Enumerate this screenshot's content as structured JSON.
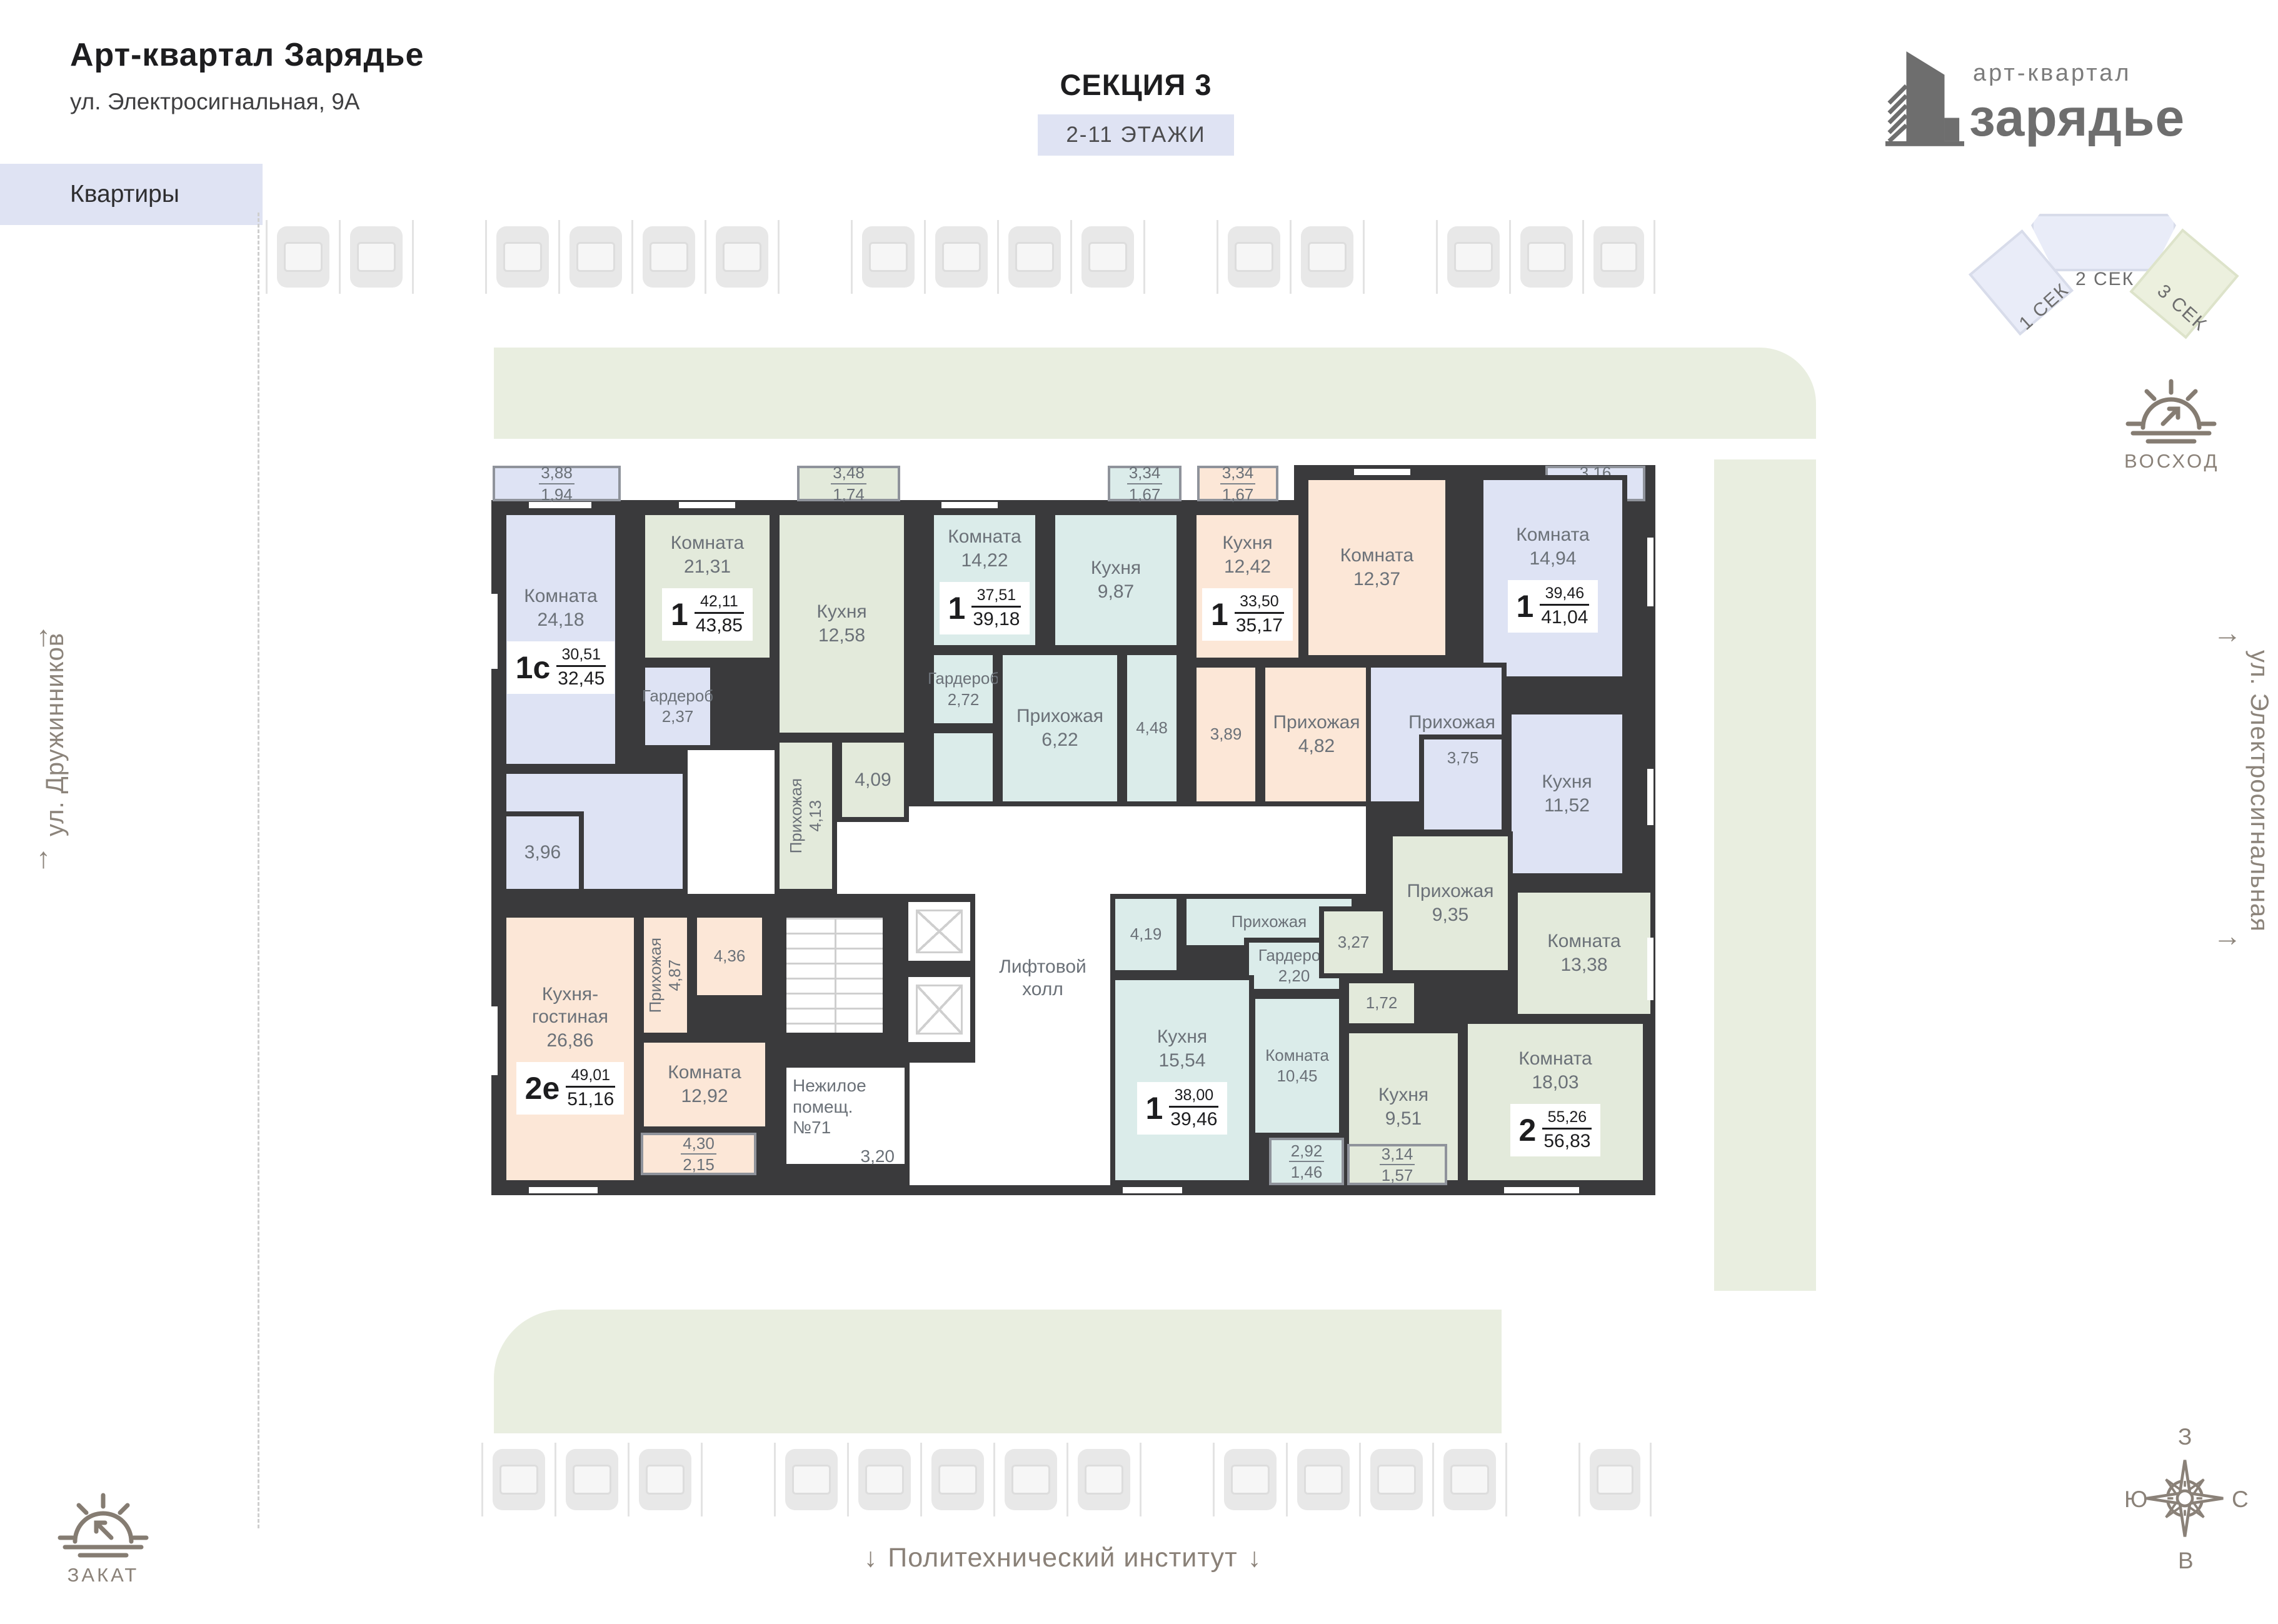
{
  "header": {
    "title": "Арт-квартал Зарядье",
    "address": "ул. Электросигнальная, 9А",
    "tab": "Квартиры"
  },
  "section": {
    "title": "СЕКЦИЯ 3",
    "floors": "2-11 ЭТАЖИ"
  },
  "logo": {
    "line1": "арт-квартал",
    "line2": "зарядье"
  },
  "minimap": {
    "sec1": "1 СЕК",
    "sec2": "2 СЕК",
    "sec3": "3 СЕК"
  },
  "orientation": {
    "sunrise": "ВОСХОД",
    "sunset": "ЗАКАТ",
    "compass": {
      "top": "З",
      "right": "С",
      "bottom": "В",
      "left": "Ю"
    }
  },
  "streets": {
    "left": "ул. Дружинников",
    "right": "ул. Электросигнальная",
    "landmark": "Политехнический институт"
  },
  "icons": {
    "up_arrow": "↑",
    "down_arrow": "↓",
    "flow_arrow": "→"
  },
  "core": {
    "lift_hall": "Лифтовой холл",
    "nonresidential": "Нежилое помещ. №71",
    "nonresidential_area": "3,20"
  },
  "apartments": [
    {
      "label": "1с",
      "area_living": "30,51",
      "area_total": "32,45",
      "rooms": [
        {
          "name": "Комната",
          "area": "24,18"
        },
        {
          "name": "",
          "area": "3,96"
        },
        {
          "name": "Гардероб",
          "area": "2,37"
        }
      ],
      "balcony": {
        "upper": "3,88",
        "lower": "1,94"
      }
    },
    {
      "label": "1",
      "area_living": "42,11",
      "area_total": "43,85",
      "rooms": [
        {
          "name": "Комната",
          "area": "21,31"
        },
        {
          "name": "Кухня",
          "area": "12,58"
        },
        {
          "name": "Прихожая",
          "area": "4,13"
        },
        {
          "name": "",
          "area": "4,09"
        }
      ],
      "balcony": {
        "upper": "3,48",
        "lower": "1,74"
      }
    },
    {
      "label": "1",
      "area_living": "37,51",
      "area_total": "39,18",
      "rooms": [
        {
          "name": "Комната",
          "area": "14,22"
        },
        {
          "name": "Кухня",
          "area": "9,87"
        },
        {
          "name": "Гардероб",
          "area": "2,72"
        },
        {
          "name": "Прихожая",
          "area": "6,22"
        },
        {
          "name": "",
          "area": "4,48"
        }
      ],
      "balcony": {
        "upper": "3,34",
        "lower": "1,67"
      }
    },
    {
      "label": "1",
      "area_living": "33,50",
      "area_total": "35,17",
      "rooms": [
        {
          "name": "Кухня",
          "area": "12,42"
        },
        {
          "name": "Комната",
          "area": "12,37"
        },
        {
          "name": "",
          "area": "3,89"
        },
        {
          "name": "Прихожая",
          "area": "4,82"
        }
      ],
      "balcony": {
        "upper": "3,34",
        "lower": "1,67"
      }
    },
    {
      "label": "1",
      "area_living": "39,46",
      "area_total": "41,04",
      "rooms": [
        {
          "name": "Комната",
          "area": "14,94"
        },
        {
          "name": "Прихожая",
          "area": "9,25"
        },
        {
          "name": "",
          "area": "3,75"
        },
        {
          "name": "Кухня",
          "area": "11,52"
        }
      ],
      "balcony": {
        "upper": "3,16",
        "lower": "1,58"
      }
    },
    {
      "label": "2е",
      "area_living": "49,01",
      "area_total": "51,16",
      "rooms": [
        {
          "name": "Кухня-гостиная",
          "area": "26,86"
        },
        {
          "name": "Прихожая",
          "area": "4,87"
        },
        {
          "name": "",
          "area": "4,36"
        },
        {
          "name": "Комната",
          "area": "12,92"
        }
      ],
      "balcony": {
        "upper": "4,30",
        "lower": "2,15"
      }
    },
    {
      "label": "1",
      "area_living": "38,00",
      "area_total": "39,46",
      "rooms": [
        {
          "name": "",
          "area": "4,19"
        },
        {
          "name": "Прихожая",
          "area": "5,62"
        },
        {
          "name": "Гардероб",
          "area": "2,20"
        },
        {
          "name": "Кухня",
          "area": "15,54"
        },
        {
          "name": "Комната",
          "area": "10,45"
        }
      ],
      "balcony": {
        "upper": "2,92",
        "lower": "1,46"
      }
    },
    {
      "label": "2",
      "area_living": "55,26",
      "area_total": "56,83",
      "rooms": [
        {
          "name": "Прихожая",
          "area": "9,35"
        },
        {
          "name": "",
          "area": "3,27"
        },
        {
          "name": "",
          "area": "1,72"
        },
        {
          "name": "Кухня",
          "area": "9,51"
        },
        {
          "name": "Комната",
          "area": "13,38"
        },
        {
          "name": "Комната",
          "area": "18,03"
        }
      ],
      "balcony": {
        "upper": "3,14",
        "lower": "1,57"
      }
    }
  ]
}
